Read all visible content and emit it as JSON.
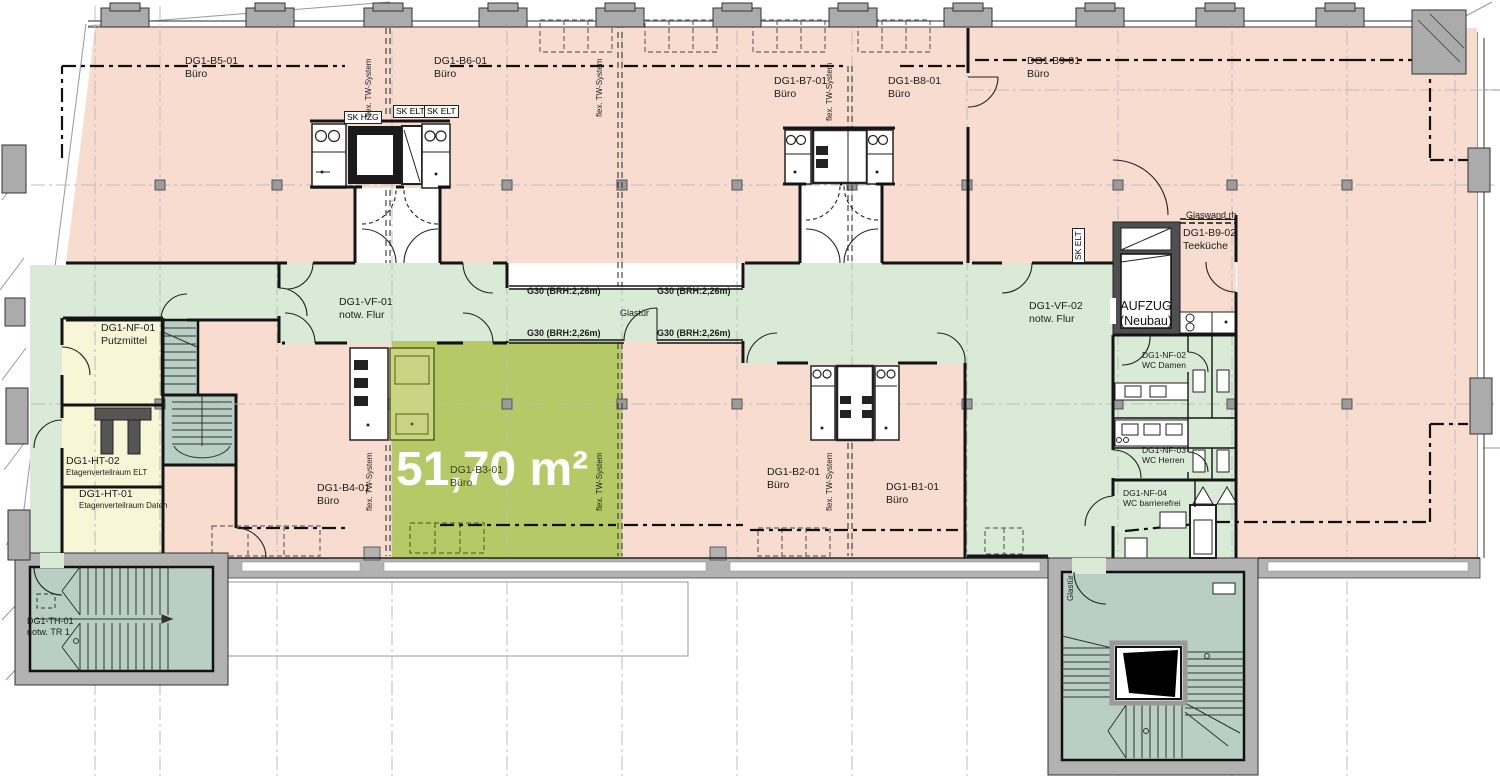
{
  "plan": {
    "rooms": [
      {
        "id": "DG1-B5-01",
        "type": "Büro"
      },
      {
        "id": "DG1-B6-01",
        "type": "Büro"
      },
      {
        "id": "DG1-B7-01",
        "type": "Büro"
      },
      {
        "id": "DG1-B8-01",
        "type": "Büro"
      },
      {
        "id": "DG1-B9-01",
        "type": "Büro"
      },
      {
        "id": "DG1-VF-01",
        "type": "notw. Flur"
      },
      {
        "id": "DG1-VF-02",
        "type": "notw. Flur"
      },
      {
        "id": "DG1-NF-01",
        "type": "Putzmittel"
      },
      {
        "id": "DG1-HT-02",
        "type": "Etagenverteilraum ELT"
      },
      {
        "id": "DG1-HT-01",
        "type": "Etagenverteilraum Daten"
      },
      {
        "id": "DG1-B4-01",
        "type": "Büro"
      },
      {
        "id": "DG1-B3-01",
        "type": "Büro"
      },
      {
        "id": "DG1-B2-01",
        "type": "Büro"
      },
      {
        "id": "DG1-B1-01",
        "type": "Büro"
      },
      {
        "id": "DG1-B9-02",
        "type": "Teeküche"
      },
      {
        "id": "DG1-NF-02",
        "type": "WC Damen"
      },
      {
        "id": "DG1-NF-03",
        "type": "WC Herren"
      },
      {
        "id": "DG1-NF-04",
        "type": "WC barrierefrei"
      },
      {
        "id": "DG1-TH-01",
        "type": "notw. TR 1"
      }
    ],
    "elevator": {
      "line1": "AUFZUG",
      "line2": "(Neubau)"
    },
    "highlight": {
      "room": "DG1-B3-01",
      "area_label": "51,70 m²"
    },
    "annotations": {
      "g30": "G30 (BRH:2,26m)",
      "glastuer": "Glastür",
      "glaswand": "Glaswand rh",
      "sk_hzg": "SK HZG",
      "sk_elt": "SK ELT",
      "tw": "flex. TW-System"
    },
    "colors": {
      "office": "#f7dccf",
      "corridor": "#d9ebd7",
      "highlight": "#b6c966",
      "stair": "#b9cfc6",
      "service_room": "#f9f5d7",
      "exterior_wall": "#b2b2b2",
      "wall": "#141414",
      "elevator_wall": "#4f4f4f",
      "highlight_text": "#ffffff"
    }
  }
}
